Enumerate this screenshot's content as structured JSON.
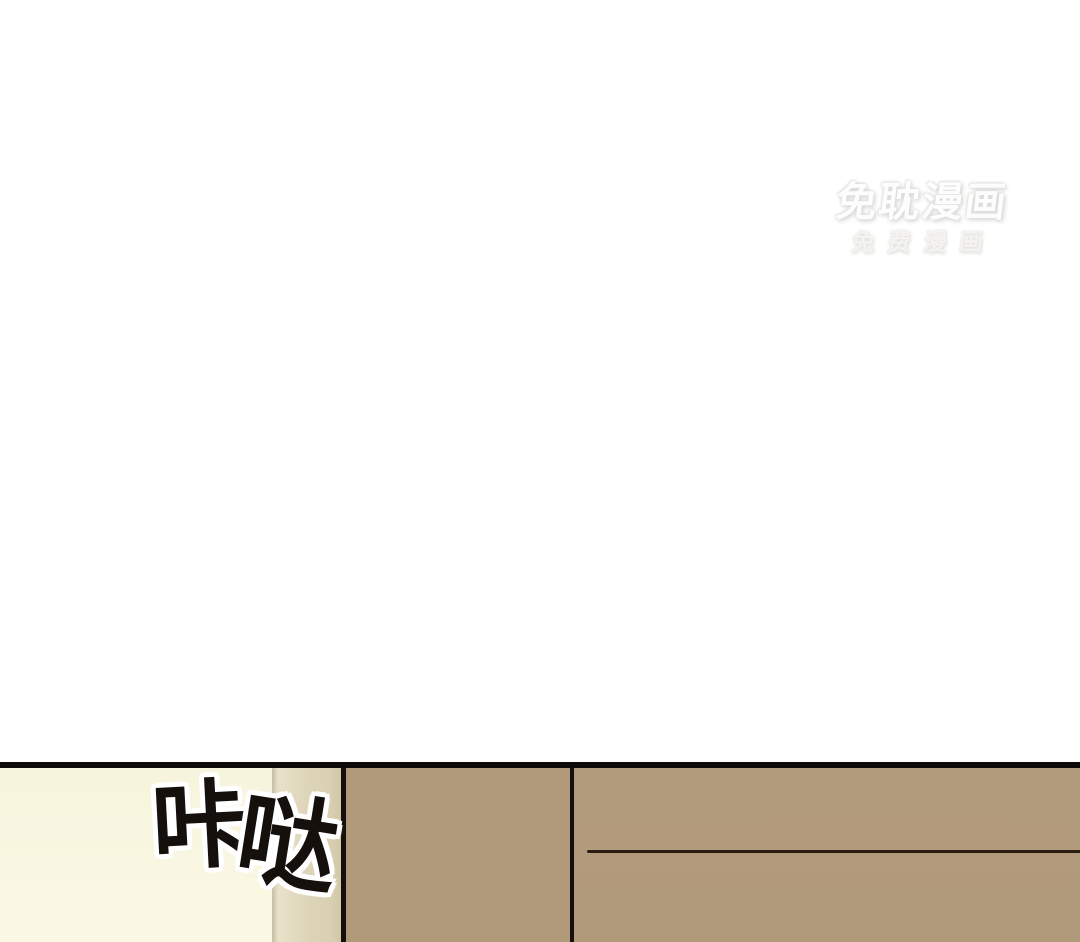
{
  "watermark": {
    "title": "免耽漫画",
    "subtitle": "免费漫画",
    "text_color": "#fdfdfd",
    "shadow_color": "#d9d8d5"
  },
  "panel": {
    "sfx": {
      "text": "咔哒",
      "chars": [
        "咔",
        "哒"
      ],
      "ink_color": "#15100c",
      "halo_color": "#ffffff"
    },
    "colors": {
      "background_white": "#ffffff",
      "border_black": "#0d0b09",
      "wall_cream_top": "#f7f4de",
      "wall_cream_bottom": "#fbf9e3",
      "door_frame_light": "#e9e1ca",
      "door_frame": "#ded5b9",
      "door_frame_shadow": "#d2c8a8",
      "door_tan": "#b19a7a",
      "outline_black": "#15100c",
      "seam_brown": "#2a1d12"
    }
  }
}
